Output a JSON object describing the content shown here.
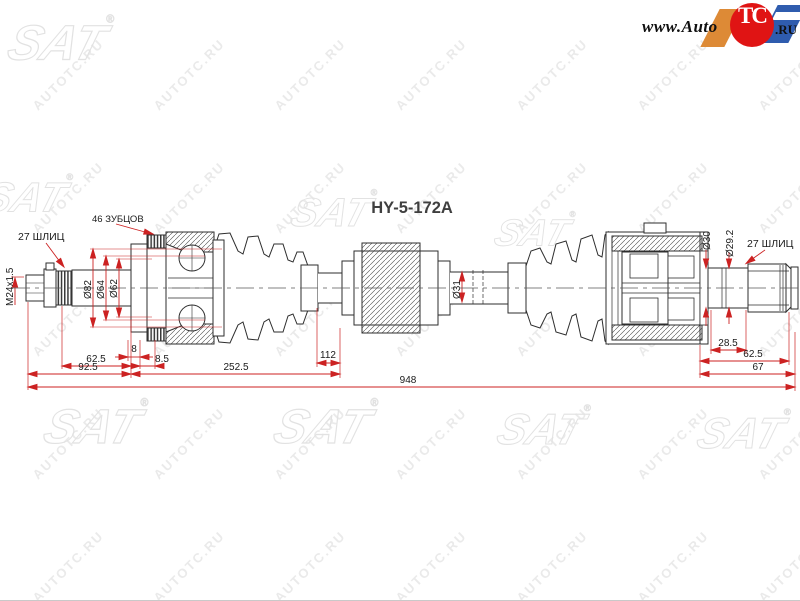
{
  "header": {
    "part_number": "HY-5-172A"
  },
  "site_logo": {
    "www_prefix": "www.Auto",
    "circle_text": "TC",
    "domain_suffix": ".RU"
  },
  "watermark": {
    "tile_text": "AUTOTC.RU",
    "brand": "SAT",
    "registered": "®"
  },
  "callouts": {
    "spline_left": "27 ШЛИЦ",
    "teeth_count": "46 ЗУБЦОВ",
    "thread_spec": "M24x1.5",
    "spline_right": "27 ШЛИЦ"
  },
  "diameters": {
    "d82": "Ø82",
    "d64": "Ø64",
    "d62": "Ø62",
    "d31": "Ø31",
    "d30": "Ø30",
    "d29_2": "Ø29.2"
  },
  "dimensions": {
    "seg_8": "8",
    "seg_62_5_left": "62.5",
    "seg_8_5": "8.5",
    "seg_92_5": "92.5",
    "seg_252_5": "252.5",
    "seg_112": "112",
    "total_948": "948",
    "seg_28_5": "28.5",
    "seg_62_5_right": "62.5",
    "seg_67": "67"
  },
  "colors": {
    "dimension_red": "#cc2222",
    "drawing_line": "#2e2e2e",
    "watermark_gray": "#e4e4e4",
    "logo_red": "#e01414",
    "logo_orange": "#dd8a36",
    "logo_blue": "#2f5cae"
  }
}
